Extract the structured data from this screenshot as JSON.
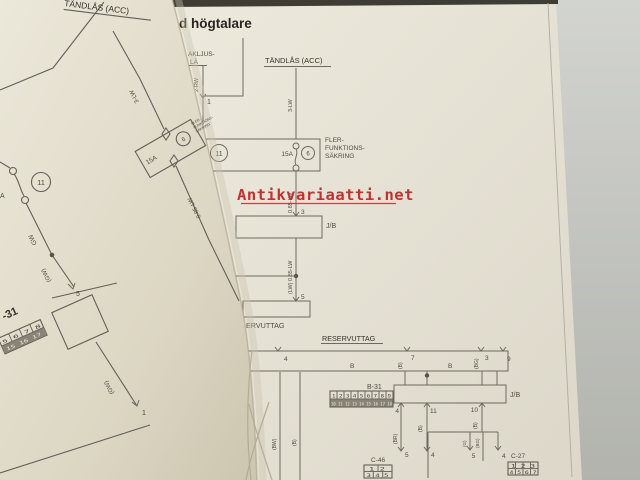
{
  "photo": {
    "background_color": "#c4c5c0",
    "page_color": "#ece8dc",
    "watermark_color": "#c13132"
  },
  "watermark": {
    "text": "Antikvariaatti.net"
  },
  "right_page": {
    "heading": "d högtalare",
    "relay_label_line1": "AKLJUS-",
    "relay_label_line2": "LÄ",
    "relay_wire": "2-RW",
    "relay_pin": "1",
    "ignition_title": "TÄNDLÅS (ACC)",
    "ignition_wire": "3-LW",
    "fuse_box": {
      "slot_no": "11",
      "amp": "15A",
      "fuse_no": "6",
      "label": [
        "FLER-",
        "FUNKTIONS-",
        "SÄKRING"
      ]
    },
    "wire_fuse_out": "0.85-LW",
    "jb_upper": {
      "pin_in": "3",
      "label": "J/B",
      "wire_out": "(LW) 0.85-LW",
      "pin_out": "5"
    },
    "outlet_label_partial": "ERVUTTAG",
    "reserve_title": "RESERVUTTAG",
    "bus": {
      "pin_4": "4",
      "pin_7": "7",
      "pin_3": "3",
      "pin_9": "9",
      "wire_b_1": "B",
      "wire_b_2": "B",
      "label_b": "(B)",
      "label_bg": "(BG)"
    },
    "b31": {
      "name": "B-31",
      "row1": [
        "1",
        "2",
        "3",
        "4",
        "5",
        "6",
        "7",
        "8",
        "9"
      ],
      "row2": [
        "10",
        "11",
        "12",
        "13",
        "14",
        "15",
        "16",
        "17",
        "18"
      ]
    },
    "jb_lower": {
      "label": "J/B",
      "pin_a": "4",
      "pin_b": "11",
      "pin_c": "10"
    },
    "drop_wires": {
      "br": "(BR)",
      "b1": "(B)",
      "b2": "(B)",
      "g": "(G)",
      "bg": "(BG)",
      "bw": "(BW)",
      "b3": "(B)"
    },
    "c46": {
      "name": "C-46",
      "pin_5": "5",
      "pin_4": "4",
      "row1": [
        "1",
        "2"
      ],
      "row2": [
        "3",
        "4",
        "5"
      ]
    },
    "c27": {
      "name": "C-27",
      "pin_5": "5",
      "pin_4": "4",
      "row1": [
        "1",
        "2",
        "3"
      ],
      "row2": [
        "4",
        "5",
        "6",
        "7"
      ]
    }
  },
  "left_page": {
    "ignition_title": "TÄNDLÅS (ACC)",
    "ignition_wire": "3-LW",
    "fuse_box": {
      "amp": "15A",
      "fuse_no": "6",
      "label": [
        "FLER-",
        "FUNKTIONS-",
        "SÄKRING"
      ]
    },
    "slot_no": "11",
    "amp_partial": "A",
    "wire_gw": "GW",
    "wire_gw_paren": "(GW)",
    "wire_out": "0.85-LW",
    "pin_5": "5",
    "connector_name_partial": "-31",
    "grid_row1": [
      "5",
      "6",
      "7",
      "8"
    ],
    "grid_row2": [
      "15",
      "16",
      "17"
    ],
    "wire_gw_lower": "(GW)",
    "pin_1": "1"
  }
}
